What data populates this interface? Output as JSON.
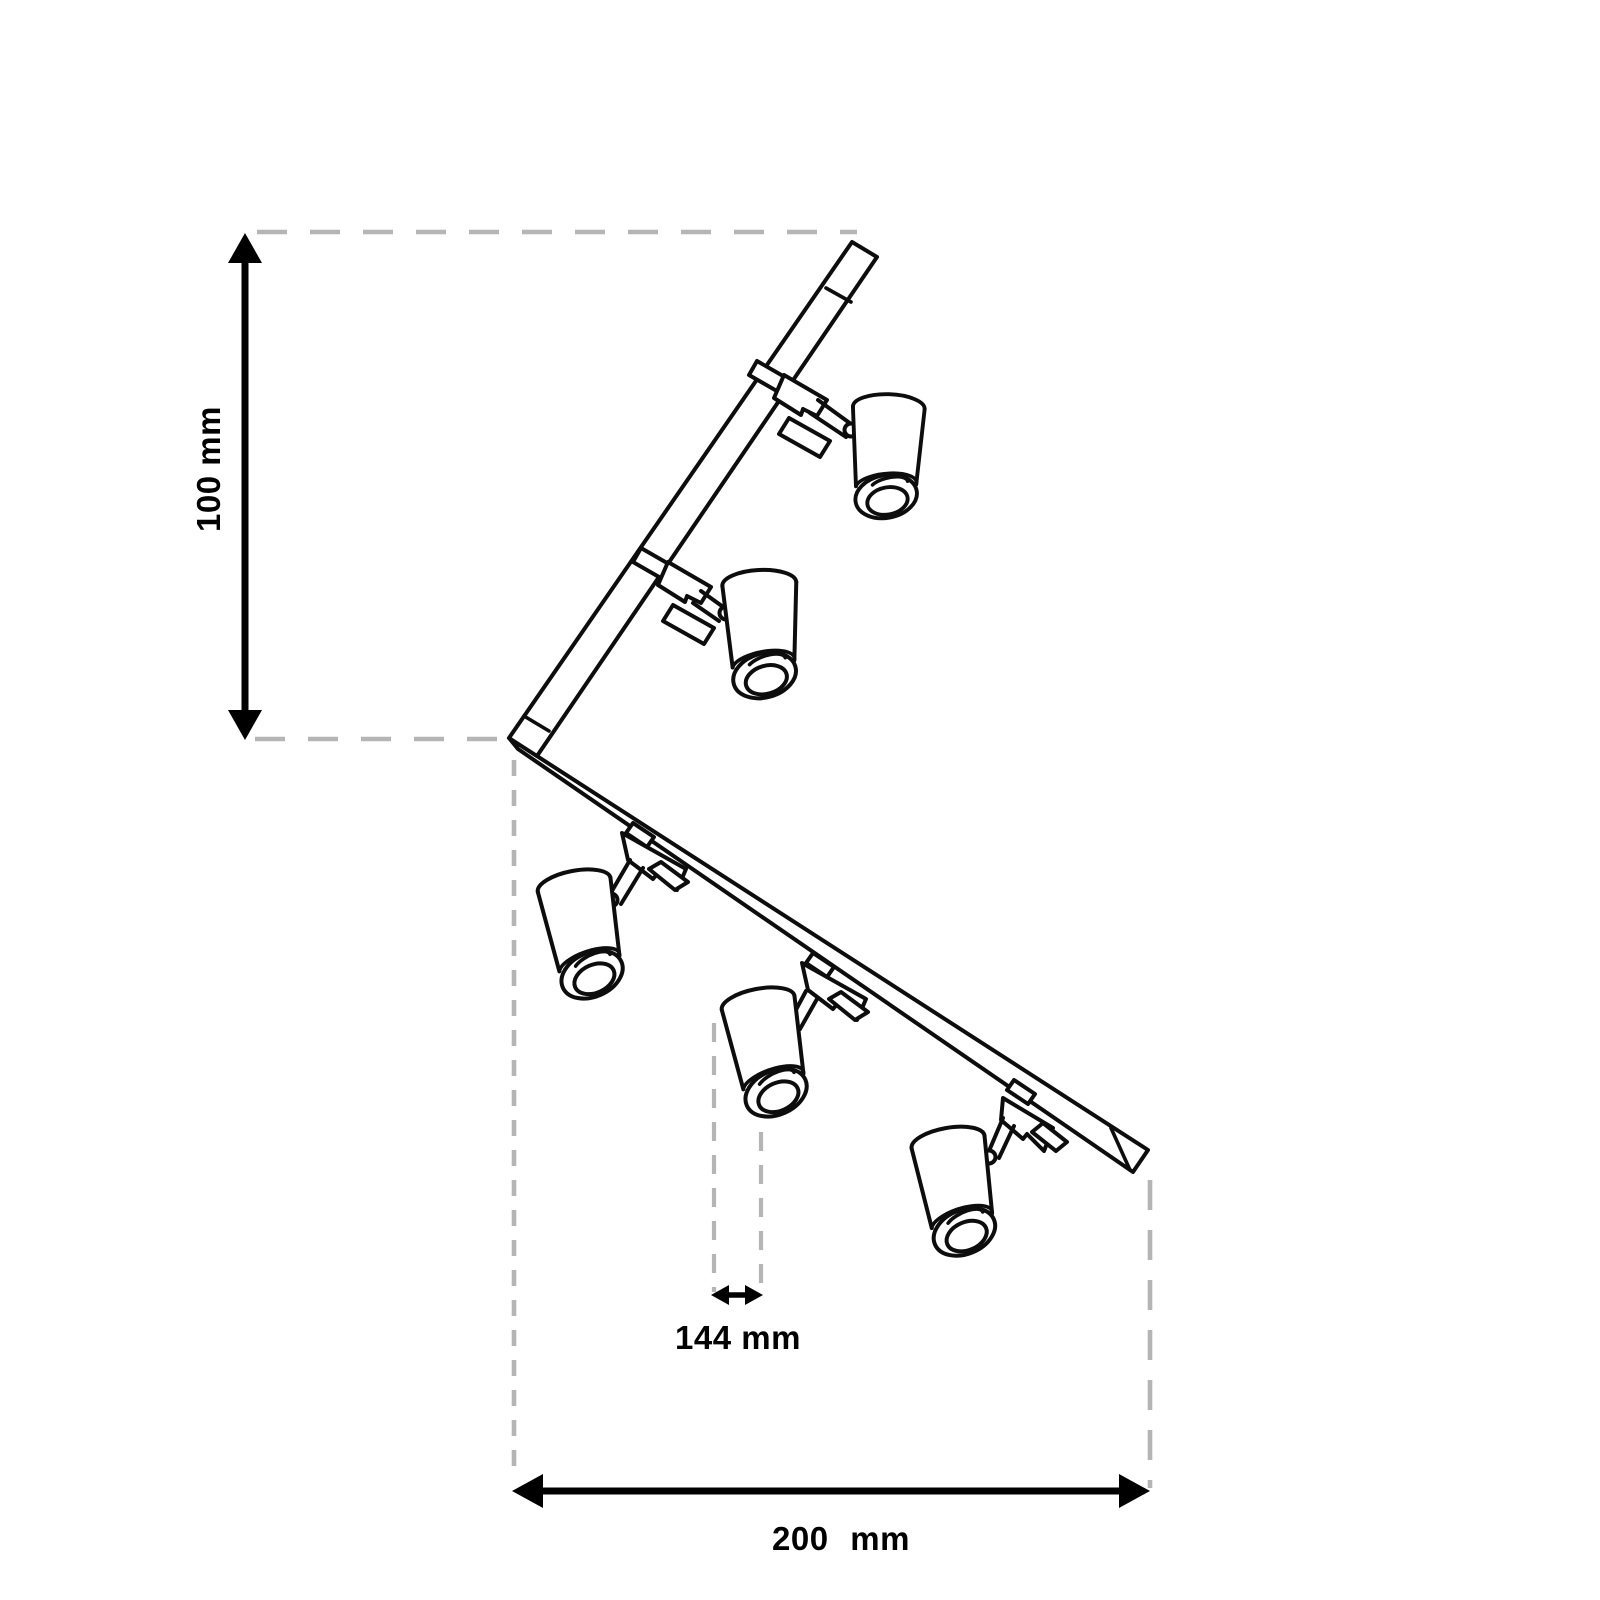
{
  "diagram": {
    "description": "Isometric technical line drawing of an L-shaped corner track lighting rail with five adjustable cylindrical spotlight heads and dimension annotations",
    "spotlight_count": 5,
    "dimensions": {
      "height_label": "100 mm",
      "spot_label": "144 mm",
      "width_label": "200 mm"
    },
    "colors": {
      "line": "#0d0d0d",
      "dash": "#b5b5b5",
      "annotation": "#000000",
      "background": "#ffffff"
    }
  }
}
